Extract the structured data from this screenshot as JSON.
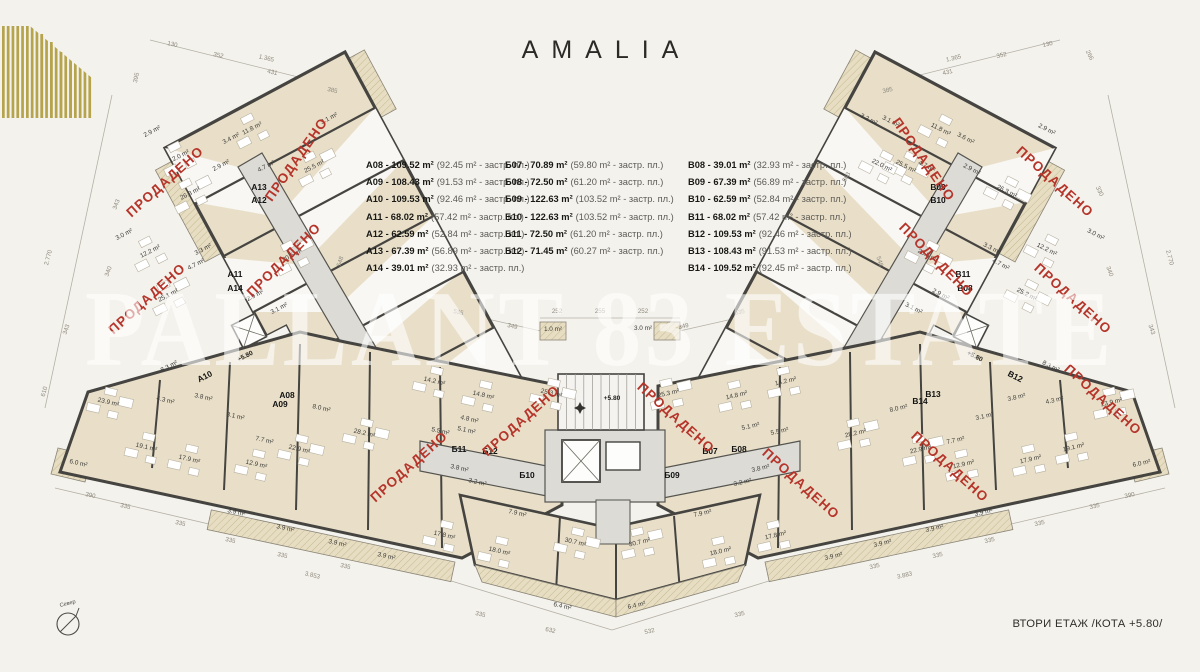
{
  "logo": {
    "name": "AMALIA"
  },
  "legend": {
    "unit_suffix": "m²",
    "built_suffix": "застр. пл.",
    "columns": [
      {
        "id": "A",
        "items": [
          {
            "unit": "A08",
            "total": "109.52 m²",
            "built": "92.45 m²"
          },
          {
            "unit": "A09",
            "total": "108.43 m²",
            "built": "91.53 m²"
          },
          {
            "unit": "A10",
            "total": "109.53 m²",
            "built": "92.46 m²"
          },
          {
            "unit": "A11",
            "total": "68.02 m²",
            "built": "57.42 m²"
          },
          {
            "unit": "A12",
            "total": "62.59 m²",
            "built": "52.84 m²"
          },
          {
            "unit": "A13",
            "total": "67.39 m²",
            "built": "56.89 m²"
          },
          {
            "unit": "A14",
            "total": "39.01 m²",
            "built": "32.93 m²"
          }
        ]
      },
      {
        "id": "Б",
        "items": [
          {
            "unit": "Б07",
            "total": "70.89 m²",
            "built": "59.80 m²"
          },
          {
            "unit": "Б08",
            "total": "72.50 m²",
            "built": "61.20 m²"
          },
          {
            "unit": "Б09",
            "total": "122.63 m²",
            "built": "103.52 m²"
          },
          {
            "unit": "Б10",
            "total": "122.63 m²",
            "built": "103.52 m²"
          },
          {
            "unit": "Б11",
            "total": "72.50 m²",
            "built": "61.20 m²"
          },
          {
            "unit": "Б12",
            "total": "71.45 m²",
            "built": "60.27 m²"
          }
        ]
      },
      {
        "id": "B",
        "items": [
          {
            "unit": "B08",
            "total": "39.01 m²",
            "built": "32.93 m²"
          },
          {
            "unit": "B09",
            "total": "67.39 m²",
            "built": "56.89 m²"
          },
          {
            "unit": "B10",
            "total": "62.59 m²",
            "built": "52.84 m²"
          },
          {
            "unit": "B11",
            "total": "68.02 m²",
            "built": "57.42 m²"
          },
          {
            "unit": "B12",
            "total": "109.53 m²",
            "built": "92.46 m²"
          },
          {
            "unit": "B13",
            "total": "108.43 m²",
            "built": "91.53 m²"
          },
          {
            "unit": "B14",
            "total": "109.52 m²",
            "built": "92.45 m²"
          }
        ]
      }
    ]
  },
  "watermark": "PALLANT 83 ESTATE",
  "footer": {
    "floor_label": "ВТОРИ ЕТАЖ /КОТА +5.80/"
  },
  "compass": {
    "label": "Север"
  },
  "colors": {
    "accent_gold": "#b5a44b",
    "sold_red": "#b5352b",
    "room_beige": "#e9dfc9",
    "wall_dark": "#454440",
    "corridor_gray": "#dcdbd6",
    "background": "#f4f2ec"
  },
  "plan": {
    "sold_stamp": "ПРОДАДЕНО",
    "area_suffix": "m²",
    "rooms": {
      "wing_left": {
        "rot": -27,
        "items": [
          [
            "2.9",
            153,
            133
          ],
          [
            "12.0",
            180,
            158
          ],
          [
            "3.4",
            232,
            140
          ],
          [
            "11.8",
            253,
            130
          ],
          [
            "3.1",
            330,
            120
          ],
          [
            "4.7",
            267,
            168
          ],
          [
            "2.9",
            222,
            167
          ],
          [
            "26.3",
            191,
            195
          ],
          [
            "25.5",
            315,
            168
          ],
          [
            "20.5",
            293,
            257
          ],
          [
            "3.0",
            125,
            236
          ],
          [
            "12.2",
            151,
            253
          ],
          [
            "3.3",
            204,
            251
          ],
          [
            "4.7",
            197,
            266
          ],
          [
            "25.1",
            169,
            297
          ],
          [
            "2.9",
            256,
            297
          ],
          [
            "3.1",
            280,
            310
          ],
          [
            "8.3",
            170,
            368
          ]
        ]
      },
      "wing_right": {
        "rot": 27,
        "items": [
          [
            "3.2",
            868,
            121
          ],
          [
            "3.1",
            890,
            123
          ],
          [
            "22.0",
            881,
            167
          ],
          [
            "11.8",
            940,
            131
          ],
          [
            "3.6",
            965,
            140
          ],
          [
            "2.9",
            1046,
            131
          ],
          [
            "4.7",
            926,
            168
          ],
          [
            "2.9",
            971,
            171
          ],
          [
            "26.3",
            1006,
            193
          ],
          [
            "25.5",
            905,
            168
          ],
          [
            "20.5",
            927,
            257
          ],
          [
            "3.0",
            1095,
            236
          ],
          [
            "12.2",
            1046,
            251
          ],
          [
            "3.3",
            991,
            250
          ],
          [
            "4.7",
            1000,
            266
          ],
          [
            "25.2",
            1026,
            296
          ],
          [
            "2.9",
            940,
            296
          ],
          [
            "3.1",
            913,
            310
          ],
          [
            "8.3",
            1050,
            368
          ]
        ]
      },
      "band_left": {
        "rot": 13,
        "items": [
          [
            "23.9",
            108,
            404
          ],
          [
            "4.3",
            165,
            402
          ],
          [
            "3.8",
            203,
            399
          ],
          [
            "3.1",
            235,
            418
          ],
          [
            "19.1",
            146,
            449
          ],
          [
            "17.9",
            189,
            461
          ],
          [
            "12.9",
            256,
            466
          ],
          [
            "7.7",
            264,
            442
          ],
          [
            "22.9",
            299,
            451
          ],
          [
            "8.0",
            321,
            410
          ],
          [
            "28.2",
            364,
            435
          ],
          [
            "6.0",
            78,
            465
          ],
          [
            "3.9",
            236,
            514
          ],
          [
            "3.9",
            285,
            530
          ],
          [
            "3.9",
            337,
            545
          ],
          [
            "3.9",
            386,
            558
          ],
          [
            "14.2",
            434,
            383
          ],
          [
            "14.8",
            483,
            397
          ],
          [
            "4.8",
            469,
            421
          ],
          [
            "5.1",
            466,
            432
          ],
          [
            "5.5",
            440,
            433
          ],
          [
            "3.8",
            459,
            470
          ],
          [
            "3.2",
            477,
            484
          ],
          [
            "25.3",
            551,
            395
          ],
          [
            "7.9",
            517,
            515
          ],
          [
            "17.8",
            444,
            537
          ],
          [
            "18.0",
            499,
            553
          ],
          [
            "30.7",
            575,
            544
          ],
          [
            "6.4",
            562,
            608
          ]
        ]
      },
      "band_right": {
        "rot": -13,
        "items": [
          [
            "23.9",
            1112,
            404
          ],
          [
            "4.3",
            1055,
            402
          ],
          [
            "3.8",
            1017,
            399
          ],
          [
            "3.1",
            985,
            418
          ],
          [
            "19.1",
            1074,
            449
          ],
          [
            "17.9",
            1031,
            461
          ],
          [
            "12.9",
            964,
            466
          ],
          [
            "7.7",
            956,
            442
          ],
          [
            "22.9",
            921,
            451
          ],
          [
            "8.0",
            899,
            410
          ],
          [
            "28.2",
            856,
            435
          ],
          [
            "6.0",
            1142,
            465
          ],
          [
            "3.9",
            984,
            514
          ],
          [
            "3.9",
            935,
            530
          ],
          [
            "3.9",
            883,
            545
          ],
          [
            "3.9",
            834,
            558
          ],
          [
            "14.2",
            786,
            383
          ],
          [
            "14.8",
            737,
            397
          ],
          [
            "5.1",
            751,
            428
          ],
          [
            "5.5",
            780,
            433
          ],
          [
            "3.8",
            761,
            470
          ],
          [
            "3.2",
            743,
            484
          ],
          [
            "25.3",
            669,
            395
          ],
          [
            "7.9",
            703,
            515
          ],
          [
            "17.8",
            776,
            537
          ],
          [
            "18.0",
            721,
            553
          ],
          [
            "30.7",
            640,
            544
          ],
          [
            "6.4",
            637,
            607
          ]
        ]
      },
      "center": {
        "rot": 0,
        "items": [
          [
            "1.0",
            553,
            331
          ],
          [
            "3.0",
            643,
            330
          ]
        ]
      }
    },
    "units": [
      [
        "A13",
        259,
        190,
        0
      ],
      [
        "A12",
        259,
        203,
        0
      ],
      [
        "A11",
        235,
        277,
        0
      ],
      [
        "A14",
        235,
        291,
        0
      ],
      [
        "A10",
        206,
        379,
        -27
      ],
      [
        "A08",
        287,
        398,
        0
      ],
      [
        "A09",
        280,
        407,
        0
      ],
      [
        "Б11",
        459,
        452,
        0
      ],
      [
        "Б12",
        490,
        454,
        0
      ],
      [
        "Б10",
        527,
        478,
        0
      ],
      [
        "Б09",
        672,
        478,
        0
      ],
      [
        "Б07",
        710,
        454,
        0
      ],
      [
        "Б08",
        739,
        452,
        0
      ],
      [
        "B09",
        938,
        190,
        0
      ],
      [
        "B10",
        938,
        203,
        0
      ],
      [
        "B11",
        963,
        277,
        0
      ],
      [
        "B08",
        965,
        291,
        0
      ],
      [
        "B12",
        1014,
        379,
        27
      ],
      [
        "B14",
        920,
        404,
        0
      ],
      [
        "B13",
        933,
        397,
        0
      ]
    ],
    "levels": [
      [
        "+5.80",
        612,
        400,
        0
      ],
      [
        "+5.80",
        246,
        358,
        -27
      ],
      [
        "+5.80",
        974,
        358,
        27
      ]
    ],
    "stamps": [
      [
        168,
        185,
        -42
      ],
      [
        300,
        162,
        -55
      ],
      [
        287,
        263,
        -45
      ],
      [
        150,
        302,
        -42
      ],
      [
        412,
        470,
        -42
      ],
      [
        524,
        424,
        -42
      ],
      [
        673,
        421,
        42
      ],
      [
        798,
        487,
        42
      ],
      [
        947,
        470,
        42
      ],
      [
        920,
        162,
        55
      ],
      [
        1052,
        185,
        42
      ],
      [
        933,
        263,
        45
      ],
      [
        1070,
        302,
        42
      ],
      [
        1100,
        403,
        42
      ]
    ],
    "dims": [
      [
        "130",
        172,
        46,
        13
      ],
      [
        "352",
        218,
        57,
        13
      ],
      [
        "1.365",
        266,
        60,
        13
      ],
      [
        "431",
        272,
        74,
        13
      ],
      [
        "385",
        332,
        92,
        13
      ],
      [
        "395",
        138,
        78,
        -78
      ],
      [
        "343",
        118,
        205,
        -70
      ],
      [
        "2.770",
        50,
        258,
        -75
      ],
      [
        "340",
        110,
        272,
        -70
      ],
      [
        "343",
        68,
        330,
        -72
      ],
      [
        "610",
        46,
        392,
        -75
      ],
      [
        "390",
        90,
        497,
        13
      ],
      [
        "335",
        125,
        508,
        13
      ],
      [
        "335",
        180,
        525,
        13
      ],
      [
        "335",
        230,
        542,
        13
      ],
      [
        "335",
        282,
        557,
        13
      ],
      [
        "3.853",
        312,
        577,
        13
      ],
      [
        "335",
        345,
        568,
        13
      ],
      [
        "632",
        550,
        632,
        13
      ],
      [
        "532",
        650,
        633,
        -13
      ],
      [
        "335",
        480,
        616,
        13
      ],
      [
        "335",
        740,
        616,
        -13
      ],
      [
        "390",
        1130,
        497,
        -13
      ],
      [
        "335",
        1095,
        508,
        -13
      ],
      [
        "335",
        1040,
        525,
        -13
      ],
      [
        "335",
        990,
        542,
        -13
      ],
      [
        "335",
        938,
        557,
        -13
      ],
      [
        "3.883",
        905,
        577,
        -13
      ],
      [
        "335",
        875,
        568,
        -13
      ],
      [
        "385",
        888,
        92,
        -13
      ],
      [
        "431",
        948,
        74,
        -13
      ],
      [
        "1.365",
        954,
        60,
        -13
      ],
      [
        "352",
        1002,
        57,
        -13
      ],
      [
        "130",
        1048,
        46,
        -13
      ],
      [
        "266",
        1088,
        56,
        62
      ],
      [
        "330",
        1098,
        192,
        64
      ],
      [
        "2.770",
        1168,
        258,
        75
      ],
      [
        "340",
        1108,
        272,
        70
      ],
      [
        "343",
        1150,
        330,
        72
      ],
      [
        "535",
        458,
        314,
        13
      ],
      [
        "349",
        512,
        328,
        13
      ],
      [
        "252",
        557,
        313,
        0
      ],
      [
        "255",
        600,
        313,
        0
      ],
      [
        "252",
        643,
        313,
        0
      ],
      [
        "349",
        684,
        328,
        -13
      ],
      [
        "535",
        740,
        314,
        -13
      ],
      [
        "548",
        342,
        262,
        -72
      ],
      [
        "548",
        878,
        262,
        72
      ],
      [
        "563",
        848,
        178,
        -60
      ]
    ]
  }
}
